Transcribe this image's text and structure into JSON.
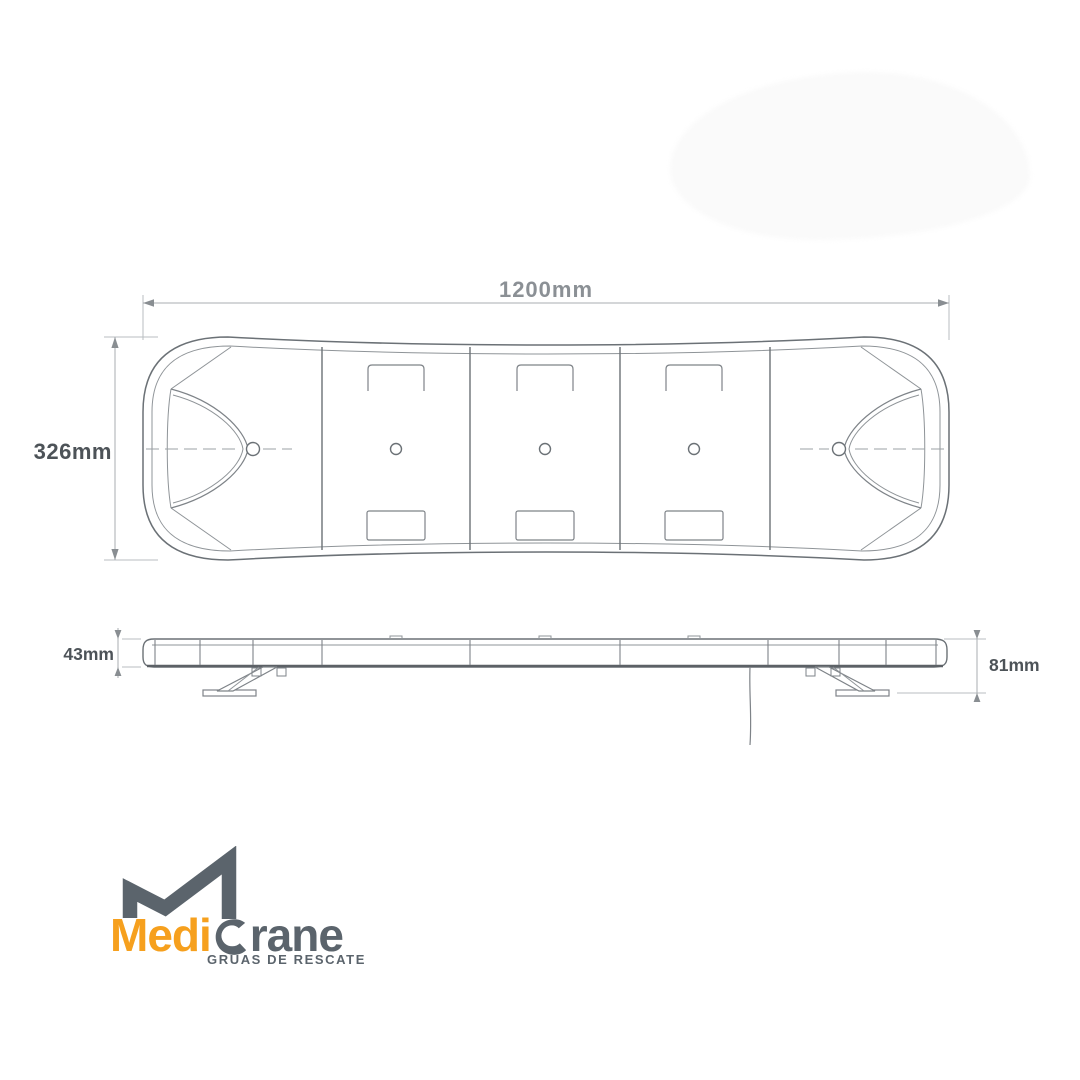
{
  "background_color": "#ffffff",
  "drawing": {
    "subject": "vehicle lightbar technical drawing, top view and side view",
    "line_color": "#82878c",
    "outline_color": "#6b7176",
    "dimension_line_color": "#aaaeb2"
  },
  "top_view": {
    "width_dim": "1200mm",
    "height_dim": "326mm"
  },
  "side_view": {
    "bar_height_dim": "43mm",
    "total_height_dim": "81mm"
  },
  "logo": {
    "brand_prefix": "Medi",
    "brand_suffix": "rane",
    "brand_full": "MediCrane",
    "tagline": "GRÚAS DE RESCATE",
    "orange": "#f6a01e",
    "slate": "#5b646c"
  }
}
